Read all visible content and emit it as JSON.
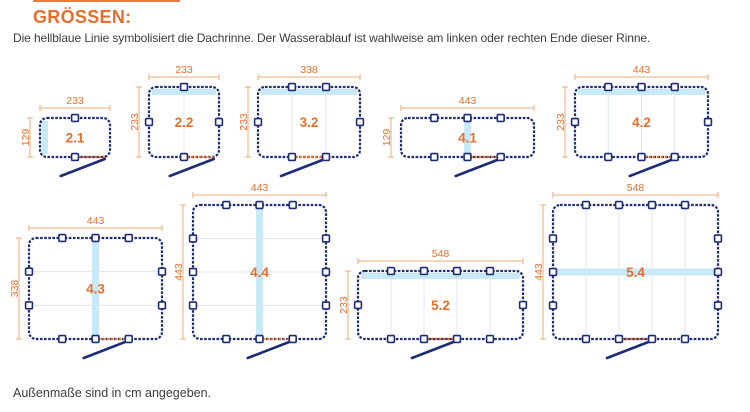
{
  "page": {
    "title": "GRÖSSEN:",
    "subtitle": "Die hellblaue Linie symbolisiert die Dachrinne. Der Wasserablauf ist wahlweise am linken oder rechten Ende dieser Rinne.",
    "footer": "Außenmaße sind in cm angegeben."
  },
  "colors": {
    "accent": "#E66E2D",
    "dim_line": "#EFA878",
    "navy": "#1D2C75",
    "gutter_blue": "#C7E9F8",
    "divider": "#DFE5EE",
    "text": "#3C3C3B",
    "bg": "#FFFFFF"
  },
  "diagrams": [
    {
      "label": "2.1",
      "width_cm": 233,
      "height_cm": 129,
      "dim_top": "233",
      "dim_side": "129",
      "x": 40,
      "y": 118,
      "w": 70,
      "h": 39,
      "top": [
        0.5
      ],
      "bottom": [
        0.5
      ],
      "left": [],
      "right": [],
      "div_v": [],
      "div_h": [],
      "gutter": "left",
      "dotted": [
        0.5,
        0.94
      ],
      "drain": 0.94
    },
    {
      "label": "2.2",
      "width_cm": 233,
      "height_cm": 233,
      "dim_top": "233",
      "dim_side": "233",
      "x": 149,
      "y": 87,
      "w": 70,
      "h": 70,
      "top": [
        0.5
      ],
      "bottom": [
        0.5
      ],
      "left": [
        0.5
      ],
      "right": [
        0.5
      ],
      "div_v": [
        0.5
      ],
      "div_h": [],
      "gutter": "top",
      "dotted": [
        0.5,
        0.94
      ],
      "drain": 0.94
    },
    {
      "label": "3.2",
      "width_cm": 338,
      "height_cm": 233,
      "dim_top": "338",
      "dim_side": "233",
      "x": 258,
      "y": 87,
      "w": 102,
      "h": 70,
      "top": [
        0.333,
        0.667
      ],
      "bottom": [
        0.333,
        0.667
      ],
      "left": [
        0.5
      ],
      "right": [
        0.5
      ],
      "div_v": [
        0.333,
        0.667
      ],
      "div_h": [],
      "gutter": "top",
      "dotted": [
        0.333,
        0.667
      ],
      "drain": 0.667
    },
    {
      "label": "4.1",
      "width_cm": 443,
      "height_cm": 129,
      "dim_top": "443",
      "dim_side": "129",
      "x": 401,
      "y": 118,
      "w": 133,
      "h": 39,
      "top": [
        0.25,
        0.5,
        0.75
      ],
      "bottom": [
        0.25,
        0.5,
        0.75
      ],
      "left": [],
      "right": [],
      "div_v": [],
      "div_h": [],
      "gutter": "center-v",
      "dotted": [
        0.5,
        0.75
      ],
      "drain": 0.75
    },
    {
      "label": "4.2",
      "width_cm": 443,
      "height_cm": 233,
      "dim_top": "443",
      "dim_side": "233",
      "x": 575,
      "y": 87,
      "w": 133,
      "h": 70,
      "top": [
        0.25,
        0.5,
        0.75
      ],
      "bottom": [
        0.25,
        0.5,
        0.75
      ],
      "left": [
        0.5
      ],
      "right": [
        0.5
      ],
      "div_v": [
        0.25,
        0.5,
        0.75
      ],
      "div_h": [],
      "gutter": "top",
      "dotted": [
        0.5,
        0.75
      ],
      "drain": 0.75
    },
    {
      "label": "4.3",
      "width_cm": 443,
      "height_cm": 338,
      "dim_top": "443",
      "dim_side": "338",
      "x": 29,
      "y": 238,
      "w": 133,
      "h": 101,
      "top": [
        0.25,
        0.5,
        0.75
      ],
      "bottom": [
        0.25,
        0.5,
        0.75
      ],
      "left": [
        0.333,
        0.667
      ],
      "right": [
        0.333,
        0.667
      ],
      "div_v": [],
      "div_h": [
        0.333,
        0.667
      ],
      "gutter": "center-v",
      "dotted": [
        0.5,
        0.75
      ],
      "drain": 0.75
    },
    {
      "label": "4.4",
      "width_cm": 443,
      "height_cm": 443,
      "dim_top": "443",
      "dim_side": "443",
      "x": 193,
      "y": 205,
      "w": 133,
      "h": 134,
      "top": [
        0.25,
        0.5,
        0.75
      ],
      "bottom": [
        0.25,
        0.5,
        0.75
      ],
      "left": [
        0.25,
        0.5,
        0.75
      ],
      "right": [
        0.25,
        0.5,
        0.75
      ],
      "div_v": [],
      "div_h": [
        0.25,
        0.5,
        0.75
      ],
      "gutter": "center-v",
      "dotted": [
        0.5,
        0.75
      ],
      "drain": 0.75
    },
    {
      "label": "5.2",
      "width_cm": 548,
      "height_cm": 233,
      "dim_top": "548",
      "dim_side": "233",
      "x": 358,
      "y": 271,
      "w": 165,
      "h": 68,
      "top": [
        0.2,
        0.4,
        0.6,
        0.8
      ],
      "bottom": [
        0.2,
        0.4,
        0.6,
        0.8
      ],
      "left": [
        0.5
      ],
      "right": [
        0.5
      ],
      "div_v": [
        0.2,
        0.4,
        0.6,
        0.8
      ],
      "div_h": [],
      "gutter": "top",
      "dotted": [
        0.4,
        0.6
      ],
      "drain": 0.6
    },
    {
      "label": "5.4",
      "width_cm": 548,
      "height_cm": 443,
      "dim_top": "548",
      "dim_side": "443",
      "x": 553,
      "y": 205,
      "w": 165,
      "h": 134,
      "top": [
        0.2,
        0.4,
        0.6,
        0.8
      ],
      "bottom": [
        0.2,
        0.4,
        0.6,
        0.8
      ],
      "left": [
        0.25,
        0.5,
        0.75
      ],
      "right": [
        0.25,
        0.5,
        0.75
      ],
      "div_v": [
        0.2,
        0.4,
        0.6,
        0.8
      ],
      "div_h": [],
      "gutter": "center-h",
      "dotted": [
        0.4,
        0.6
      ],
      "drain": 0.6
    }
  ]
}
